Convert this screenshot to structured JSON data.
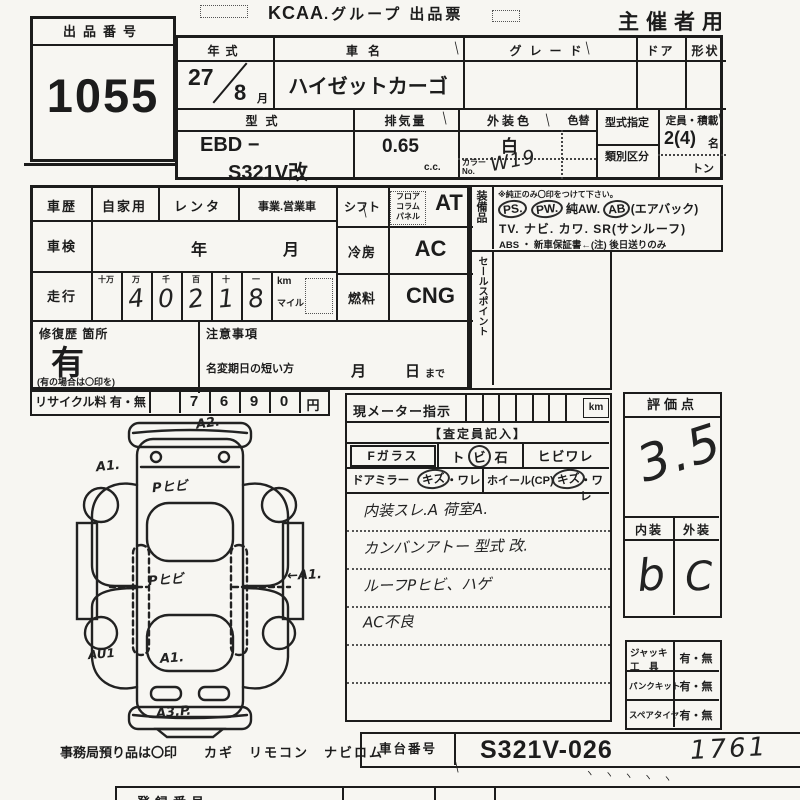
{
  "header": {
    "exhibit_label": "出品番号",
    "exhibit_number": "1055",
    "brand": "KCAA",
    "title": ".グループ 出品票",
    "organizer": "主催者用"
  },
  "vehicle": {
    "year_label": "年式",
    "year": "27",
    "month": "8",
    "month_unit": "月",
    "name_label": "車名",
    "name": "ハイゼットカーゴ",
    "grade_label": "グレード",
    "door_label": "ドア",
    "shape_label": "形状",
    "model_label": "型式",
    "model_line1": "EBD −",
    "model_line2": "S321V改",
    "disp_label": "排気量",
    "disp_value": "0.65",
    "disp_unit": "c.c.",
    "color_label": "外装色",
    "color_value": "白",
    "color_no_label_1": "カラー",
    "color_no_label_2": "No.",
    "color_no": "W19",
    "recolor_label": "色替",
    "designation_label": "型式指定",
    "classification_label": "類別区分",
    "capacity_label": "定員・積載",
    "capacity_value": "2(4)",
    "capacity_unit": "名",
    "ton_label": "トン"
  },
  "history": {
    "history_label": "車歴",
    "private": "自家用",
    "rental": "レンタ",
    "business": "事業.営業車",
    "shaken_label": "車検",
    "shaken_year": "年",
    "shaken_month": "月",
    "mileage_label": "走行",
    "digit_units": [
      "十万",
      "万",
      "千",
      "百",
      "十",
      "一"
    ],
    "mileage_digits": [
      "",
      "4",
      "0",
      "2",
      "1",
      "8"
    ],
    "km_label": "km",
    "mile_label": "マイル",
    "repair_label": "修復歴 箇所",
    "repair_value": "有",
    "repair_note": "(有の場合は〇印を)",
    "caution_label": "注意事項",
    "name_change_label": "名変期日の短い方",
    "month_label": "月",
    "day_label": "日",
    "made_label": "まで",
    "shift_label": "シフト",
    "shift_opts": [
      "フロア",
      "コラム",
      "パネル"
    ],
    "shift_value": "AT",
    "cooling_label": "冷房",
    "cooling_value": "AC",
    "fuel_label": "燃料",
    "fuel_value": "CNG",
    "equipment_label": "装備品",
    "sales_label": "セールスポイント",
    "recycle_label": "リサイクル料 有・無",
    "recycle_digits": [
      "",
      "7",
      "6",
      "9",
      "0"
    ],
    "yen_label": "円"
  },
  "equipment": {
    "note": "※純正のみ〇印をつけて下さい。",
    "ps": "PS.",
    "pw": "PW.",
    "aw": "純AW.",
    "ab": "AB",
    "airbag": "(エアバック)",
    "line2": "TV. ナビ. カワ. SR(サンルーフ)",
    "line3": "ABS ・ 新車保証書←(注) 後日送りのみ"
  },
  "inspection": {
    "meter_label": "現メーター指示",
    "meter_unit": "km",
    "assessor_label": "【査定員記入】",
    "f_glass": "Fガラス",
    "stone_pre": "ト",
    "stone_circled": "ビ",
    "stone_post": "石",
    "crack": "ヒビワレ",
    "mirror_label": "ドアミラー",
    "scratch": "キズ",
    "ware": "・ワレ",
    "wheel_label": "ホイール(CP)",
    "notes": [
      "内装スレ.A 荷室A.",
      "カンバンアトー 型式 改.",
      "ルーフPヒビ、ハゲ",
      "AC不良"
    ]
  },
  "rating": {
    "label": "評価点",
    "score": "3.5",
    "interior_label": "内装",
    "exterior_label": "外装",
    "interior_grade": "b",
    "exterior_grade": "C"
  },
  "accessories": {
    "jack_line1": "ジャッキ",
    "jack_line2": "工　具",
    "jack_value": "有・無",
    "flat_label": "パンクキット",
    "flat_value": "有・無",
    "spare_label": "スペアタイヤ",
    "spare_value": "有・無"
  },
  "chassis": {
    "label": "車台番号",
    "printed": "S321V-026",
    "handwritten": "1761"
  },
  "footer": {
    "office_note": "事務局預り品は〇印",
    "deposit_items": "カギ　リモコン　ナビロム",
    "reg_label": "登録番号"
  },
  "diagram": {
    "front": "A2.",
    "front_left": "A1.",
    "hood": "Pヒビ",
    "roof": "Pヒビ",
    "right_side": "←A1.",
    "rear_left": "AU1",
    "rear": "A1.",
    "rear_bumper": "A3.P."
  },
  "misc": {
    "tick": "＼",
    "tick_row": "ヽ ヽ ヽ ヽ ヽ"
  }
}
